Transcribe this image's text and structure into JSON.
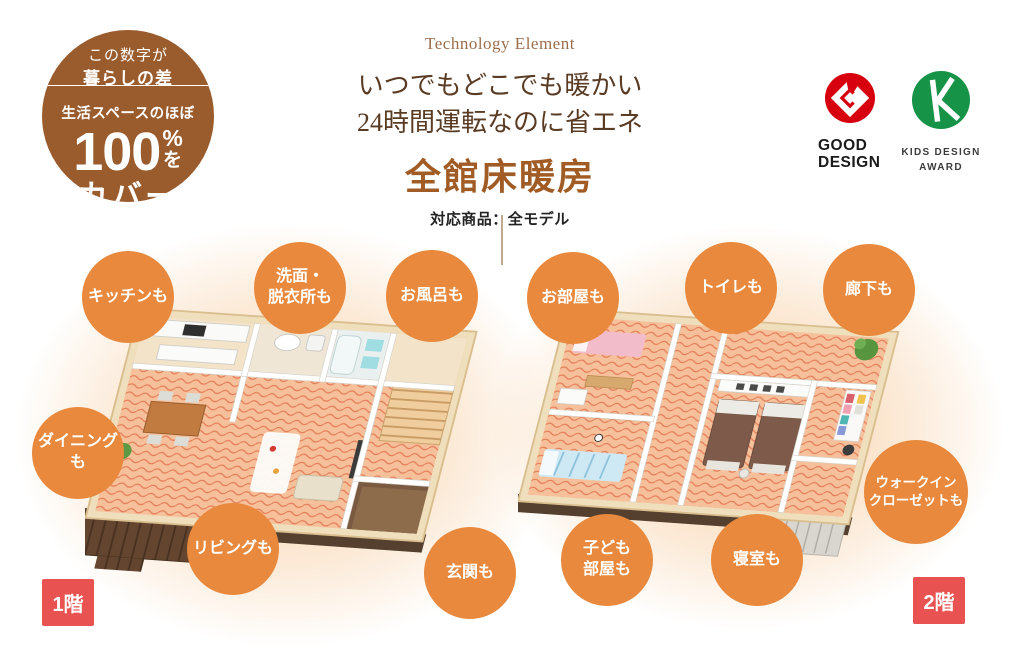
{
  "colors": {
    "accent-orange": "#E8893D",
    "badge-brown": "#9A5B2D",
    "floor-badge-red": "#E85250",
    "title-brown": "#A05C24",
    "headline-brown": "#5A3B24",
    "eyebrow-brown": "#9D6E4B",
    "good-design-red": "#D7000F",
    "kids-design-green": "#169347"
  },
  "badge": {
    "top1": "この数字が",
    "top2": "暮らしの差",
    "lead": "生活スペースのほぼ",
    "number": "100",
    "percent": "%",
    "particle": "を",
    "bottom": "カバー"
  },
  "header": {
    "eyebrow": "Technology Element",
    "line1": "いつでもどこでも暖かい",
    "line2": "24時間運転なのに省エネ",
    "title": "全館床暖房",
    "subtitle": "対応商品：全モデル"
  },
  "awards": {
    "good": {
      "line1": "GOOD",
      "line2": "DESIGN"
    },
    "kids": {
      "line1": "KIDS DESIGN",
      "line2": "AWARD"
    }
  },
  "floor1": {
    "label": "1階",
    "callouts": [
      {
        "lines": [
          "キッチンも"
        ]
      },
      {
        "lines": [
          "洗面・",
          "脱衣所も"
        ]
      },
      {
        "lines": [
          "お風呂も"
        ]
      },
      {
        "lines": [
          "ダイニングも"
        ]
      },
      {
        "lines": [
          "リビングも"
        ]
      },
      {
        "lines": [
          "玄関も"
        ]
      }
    ]
  },
  "floor2": {
    "label": "2階",
    "callouts": [
      {
        "lines": [
          "お部屋も"
        ]
      },
      {
        "lines": [
          "トイレも"
        ]
      },
      {
        "lines": [
          "廊下も"
        ]
      },
      {
        "lines": [
          "子ども",
          "部屋も"
        ]
      },
      {
        "lines": [
          "寝室も"
        ]
      },
      {
        "lines": [
          "ウォークイン",
          "クローゼットも"
        ]
      }
    ]
  }
}
